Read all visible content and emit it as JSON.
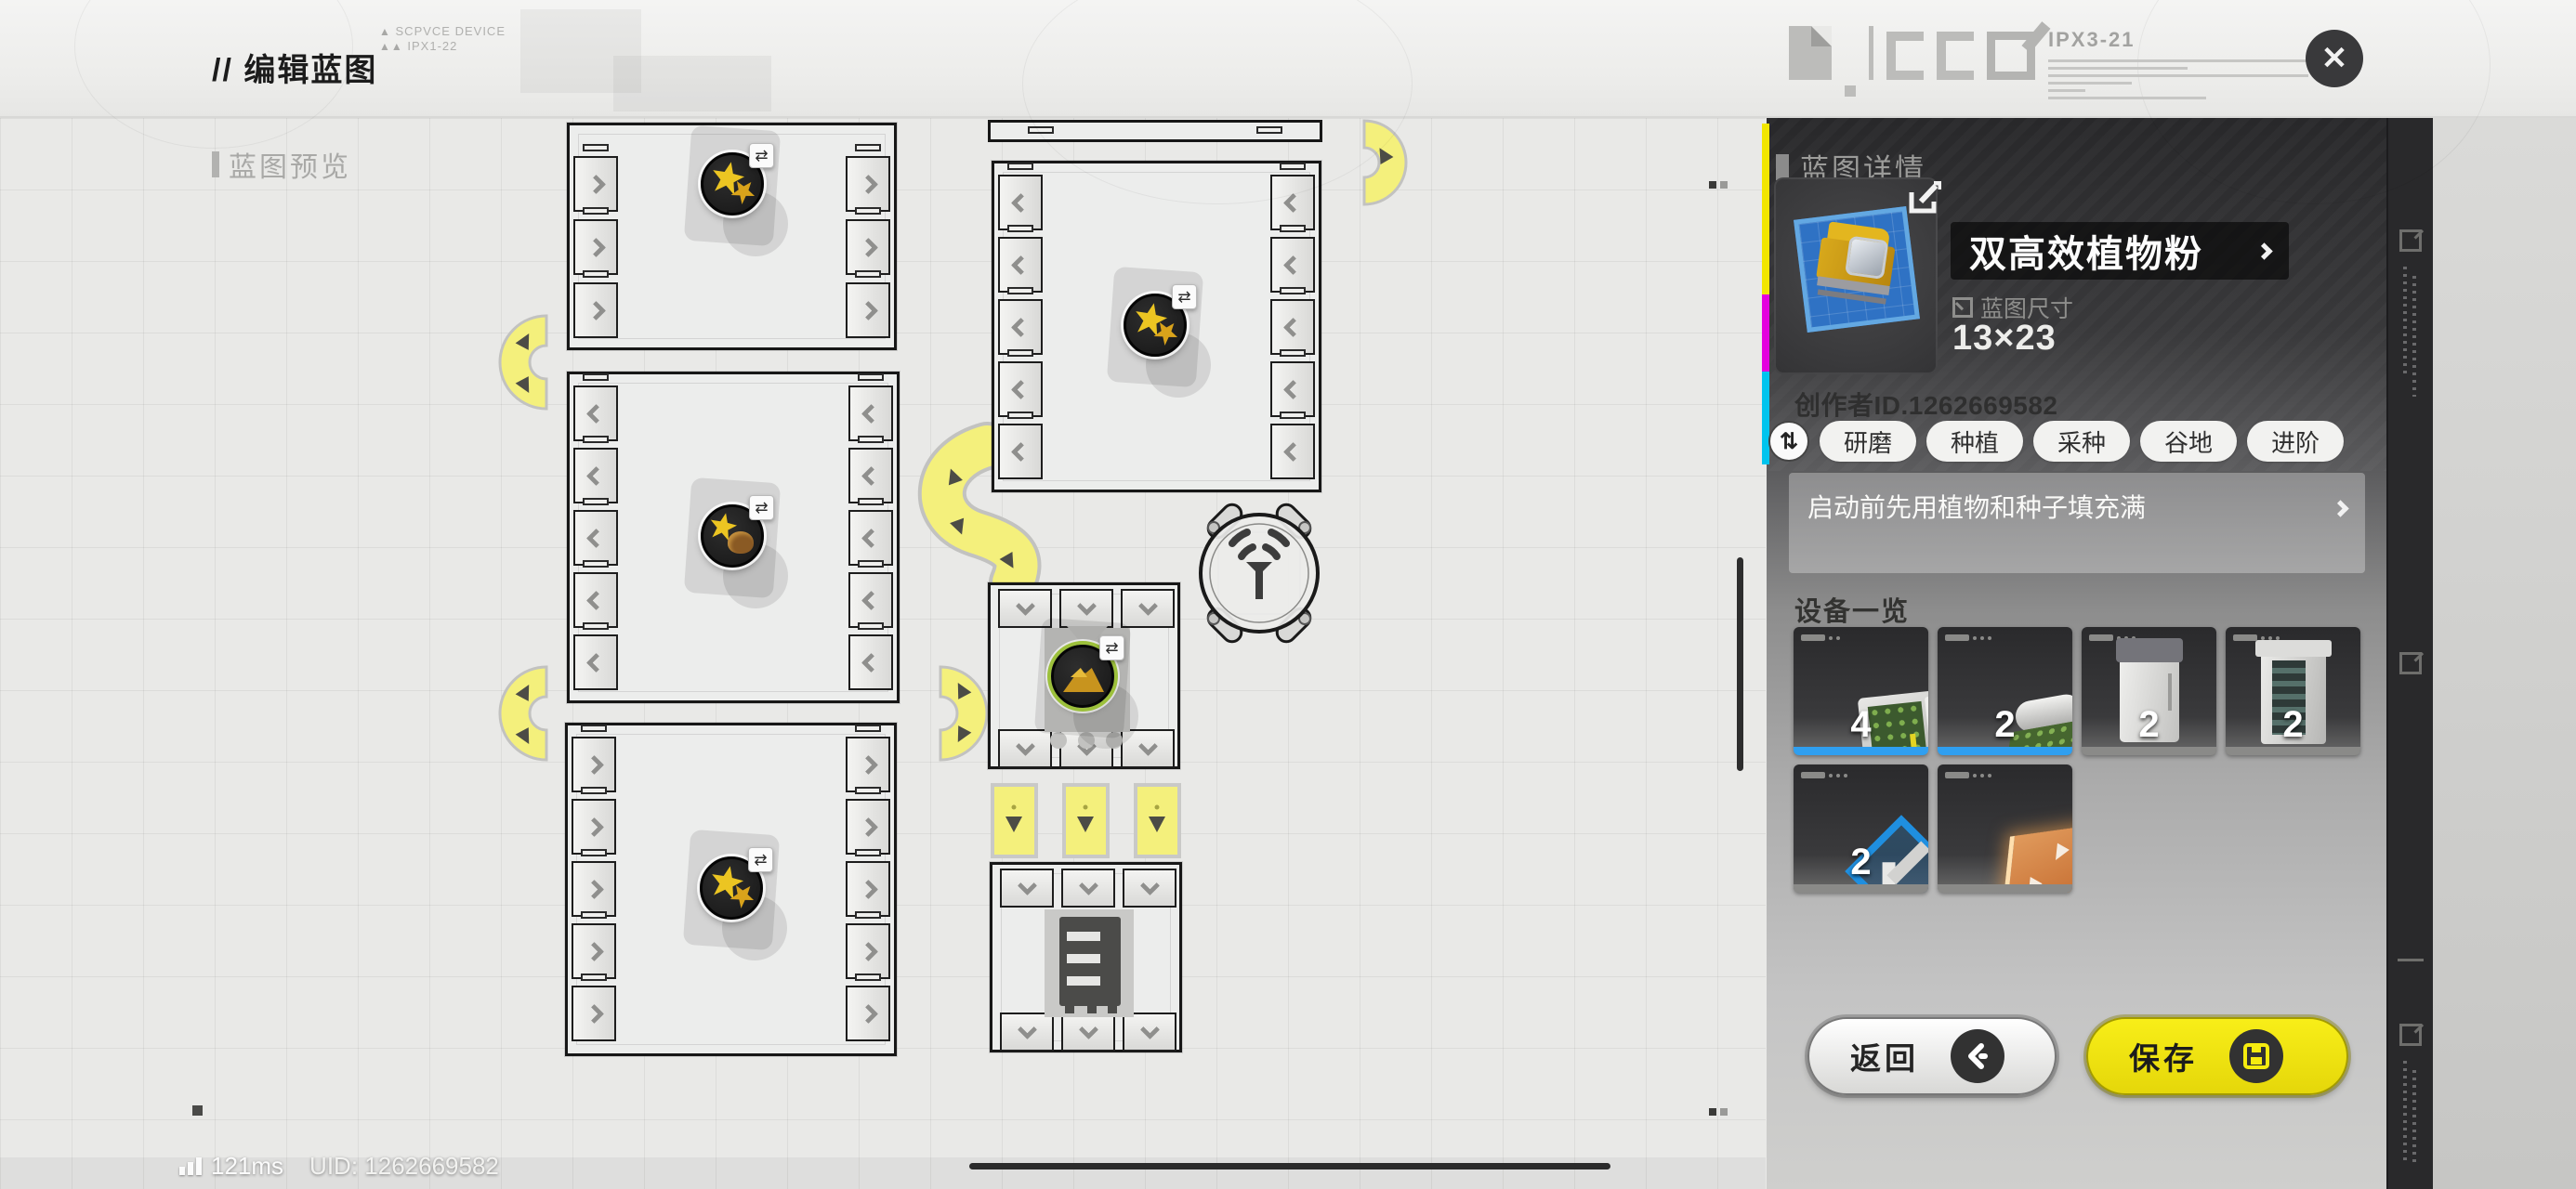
{
  "header": {
    "title": "// 编辑蓝图",
    "device_code_1": "SCPVCE DEVICE",
    "device_code_2": "IPX1-22",
    "spec_code": "IPX3-21",
    "close_glyph": "✕"
  },
  "canvas": {
    "preview_label": "蓝图预览"
  },
  "panel": {
    "title": "蓝图详情",
    "item_name": "双高效植物粉",
    "size_label": "蓝图尺寸",
    "size_value": "13×23",
    "creator": "创作者ID.1262669582",
    "refresh_glyph": "⇅",
    "tags": [
      "研磨",
      "种植",
      "采种",
      "谷地",
      "进阶"
    ],
    "description": "启动前先用植物和种子填充满",
    "devices_title": "设备一览",
    "devices": [
      {
        "icon": "seed-planting-unit",
        "count": "4",
        "accent": "#2f9ff0"
      },
      {
        "icon": "harvest-roller-unit",
        "count": "2",
        "accent": "#2f9ff0"
      },
      {
        "icon": "silo-cabinet",
        "count": "2",
        "accent": "#8a8a88"
      },
      {
        "icon": "stack-tower",
        "count": "2",
        "accent": "#8a8a88"
      },
      {
        "icon": "hoist-frame",
        "count": "2",
        "accent": "#8a8a88"
      },
      {
        "icon": "conveyor-tile",
        "count": "",
        "accent": "#8a8a88"
      }
    ],
    "back_label": "返回",
    "save_label": "保存"
  },
  "footer": {
    "ping": "121ms",
    "uid": "UID: 1262669582"
  },
  "colors": {
    "accent_yellow": "#f0e613",
    "accent_blue": "#2f9ff0",
    "conveyor_yellow": "#f4f07c",
    "panel_dark": "#28282a"
  }
}
